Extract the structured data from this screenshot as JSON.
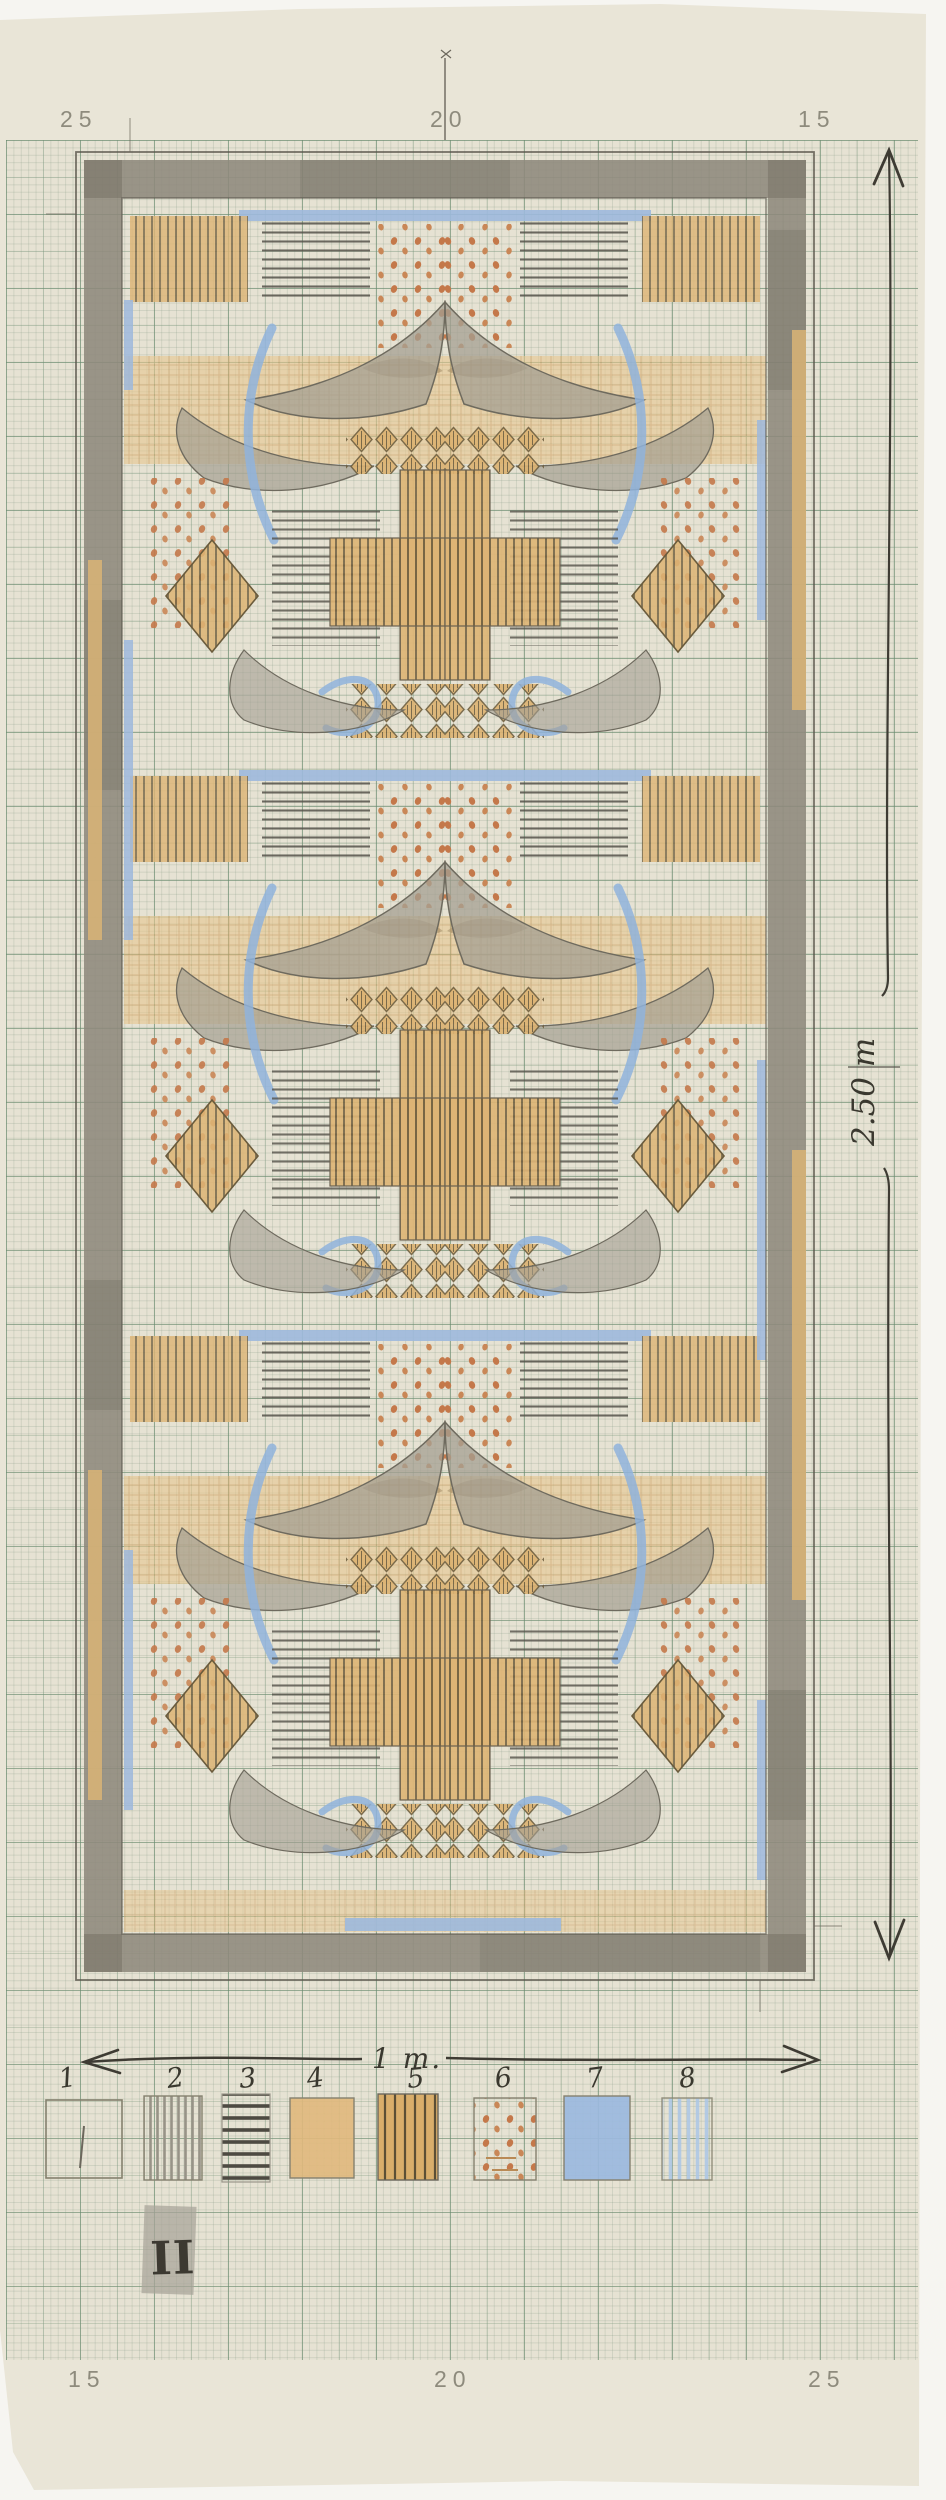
{
  "sheet": {
    "ruler_numbers_top": [
      "25",
      "20",
      "15"
    ],
    "ruler_numbers_bottom": [
      "15",
      "20",
      "25"
    ]
  },
  "annotations": {
    "height_dimension": "2.50 m",
    "scale_bar": "1 m.",
    "sheet_number": "II"
  },
  "legend": {
    "items": [
      {
        "number": "1",
        "swatch": "plain-ground"
      },
      {
        "number": "2",
        "swatch": "gray-vertical-hatch"
      },
      {
        "number": "3",
        "swatch": "dark-horizontal-stripes"
      },
      {
        "number": "4",
        "swatch": "solid-ochre"
      },
      {
        "number": "5",
        "swatch": "ochre-vertical-stripes"
      },
      {
        "number": "6",
        "swatch": "orange-dots"
      },
      {
        "number": "7",
        "swatch": "solid-blue"
      },
      {
        "number": "8",
        "swatch": "pale-blue-hatch"
      }
    ]
  },
  "palette": {
    "paper": "#e6e2d4",
    "grid_major": "#688a6e",
    "frame_gray": "#8e897c",
    "ochre": "#dcb271",
    "orange_dot": "#c4784a",
    "blue": "#8fb3dc",
    "leaf_gray": "#a49f92",
    "pencil_dark": "#4a463d"
  }
}
